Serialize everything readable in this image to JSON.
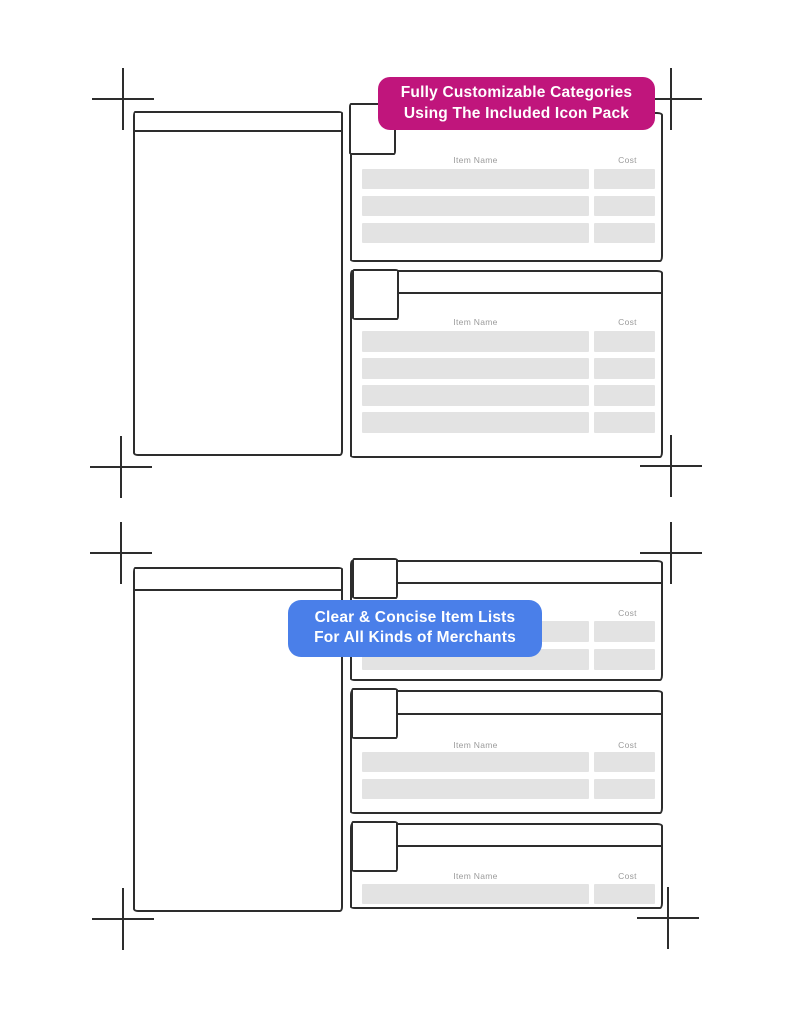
{
  "colors": {
    "callout_pink": "#C0157C",
    "callout_blue": "#4A7FE9",
    "outline_ink": "#2D2D2D",
    "row_fill": "#E3E3E3",
    "column_label_gray": "#9B9B9B"
  },
  "callouts": {
    "pink": {
      "line1": "Fully Customizable Categories",
      "line2": "Using The Included Icon Pack"
    },
    "blue": {
      "line1": "Clear & Concise Item Lists",
      "line2": "For All Kinds of Merchants"
    }
  },
  "list_headers": {
    "item": "Item Name",
    "cost": "Cost"
  }
}
